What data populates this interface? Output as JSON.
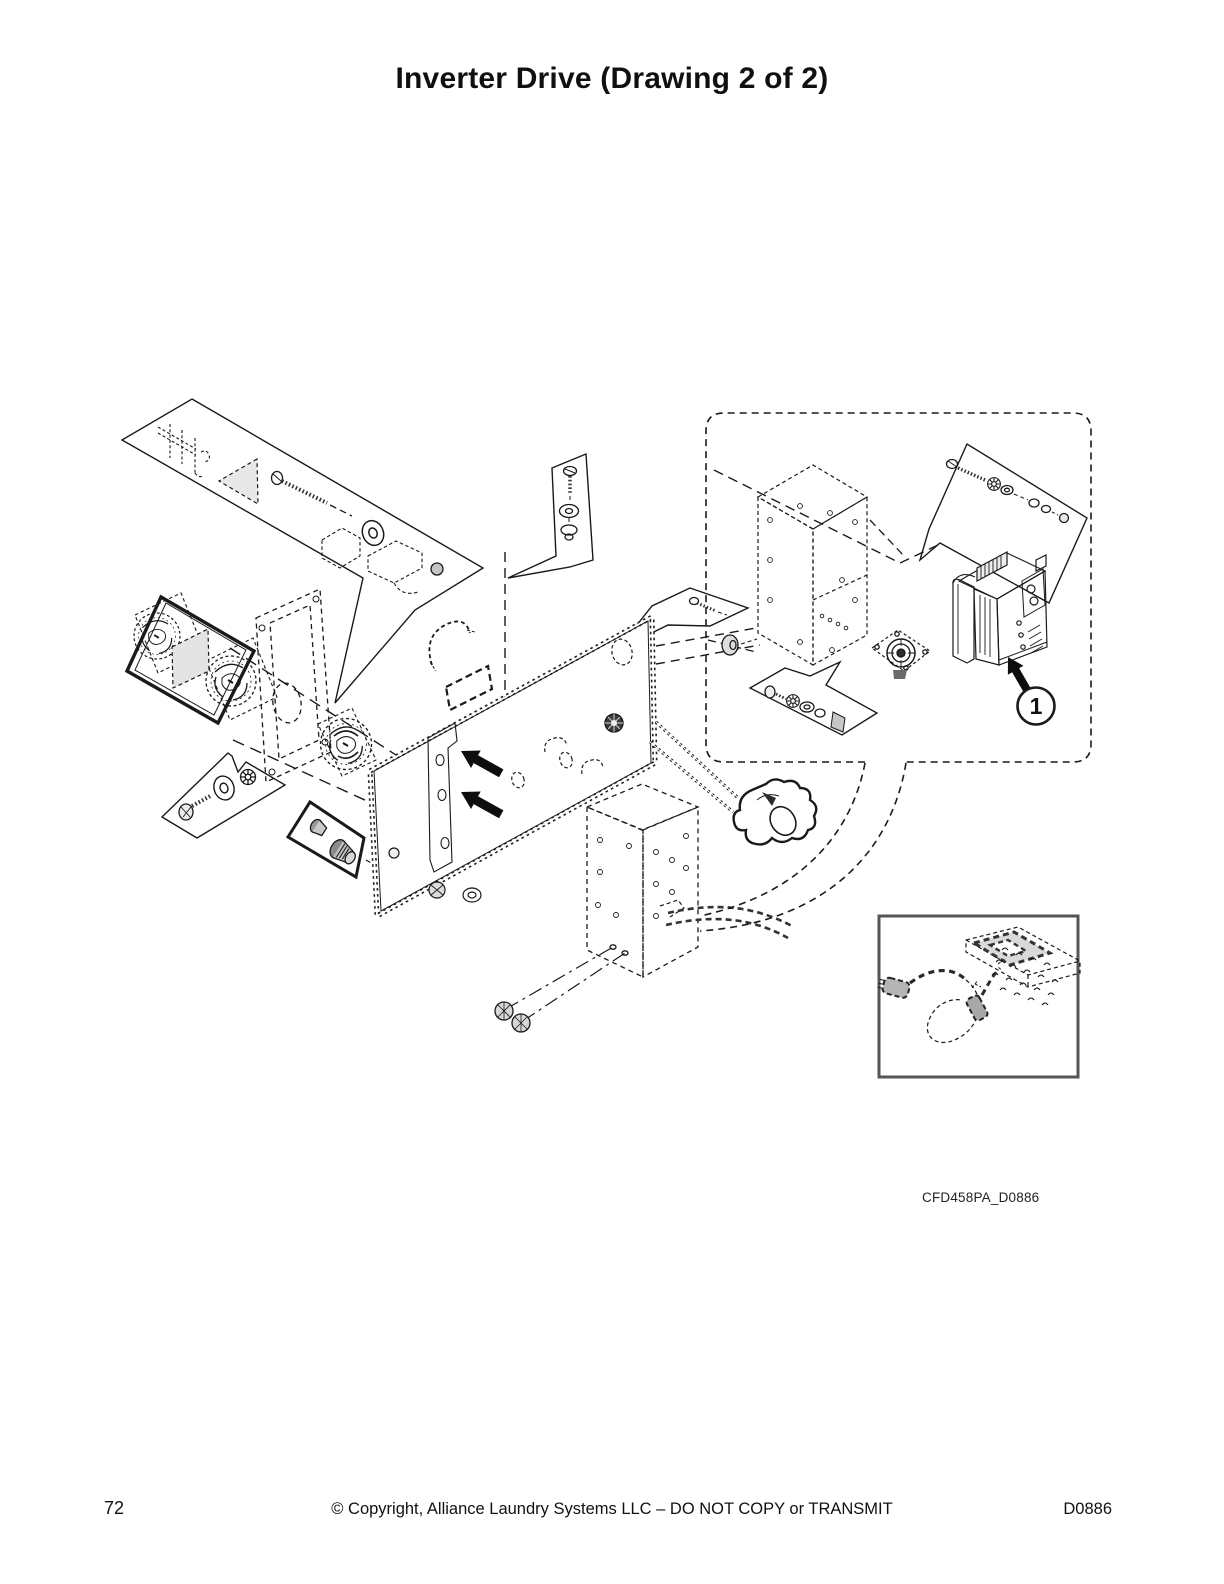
{
  "page": {
    "title": "Inverter Drive (Drawing 2 of 2)",
    "figure": {
      "code": "CFD458PA_D0886",
      "callouts": [
        {
          "number": "1"
        }
      ]
    },
    "footer": {
      "page_number": "72",
      "copyright": "© Copyright, Alliance Laundry Systems LLC – DO NOT COPY or TRANSMIT",
      "doc_number": "D0886"
    }
  }
}
